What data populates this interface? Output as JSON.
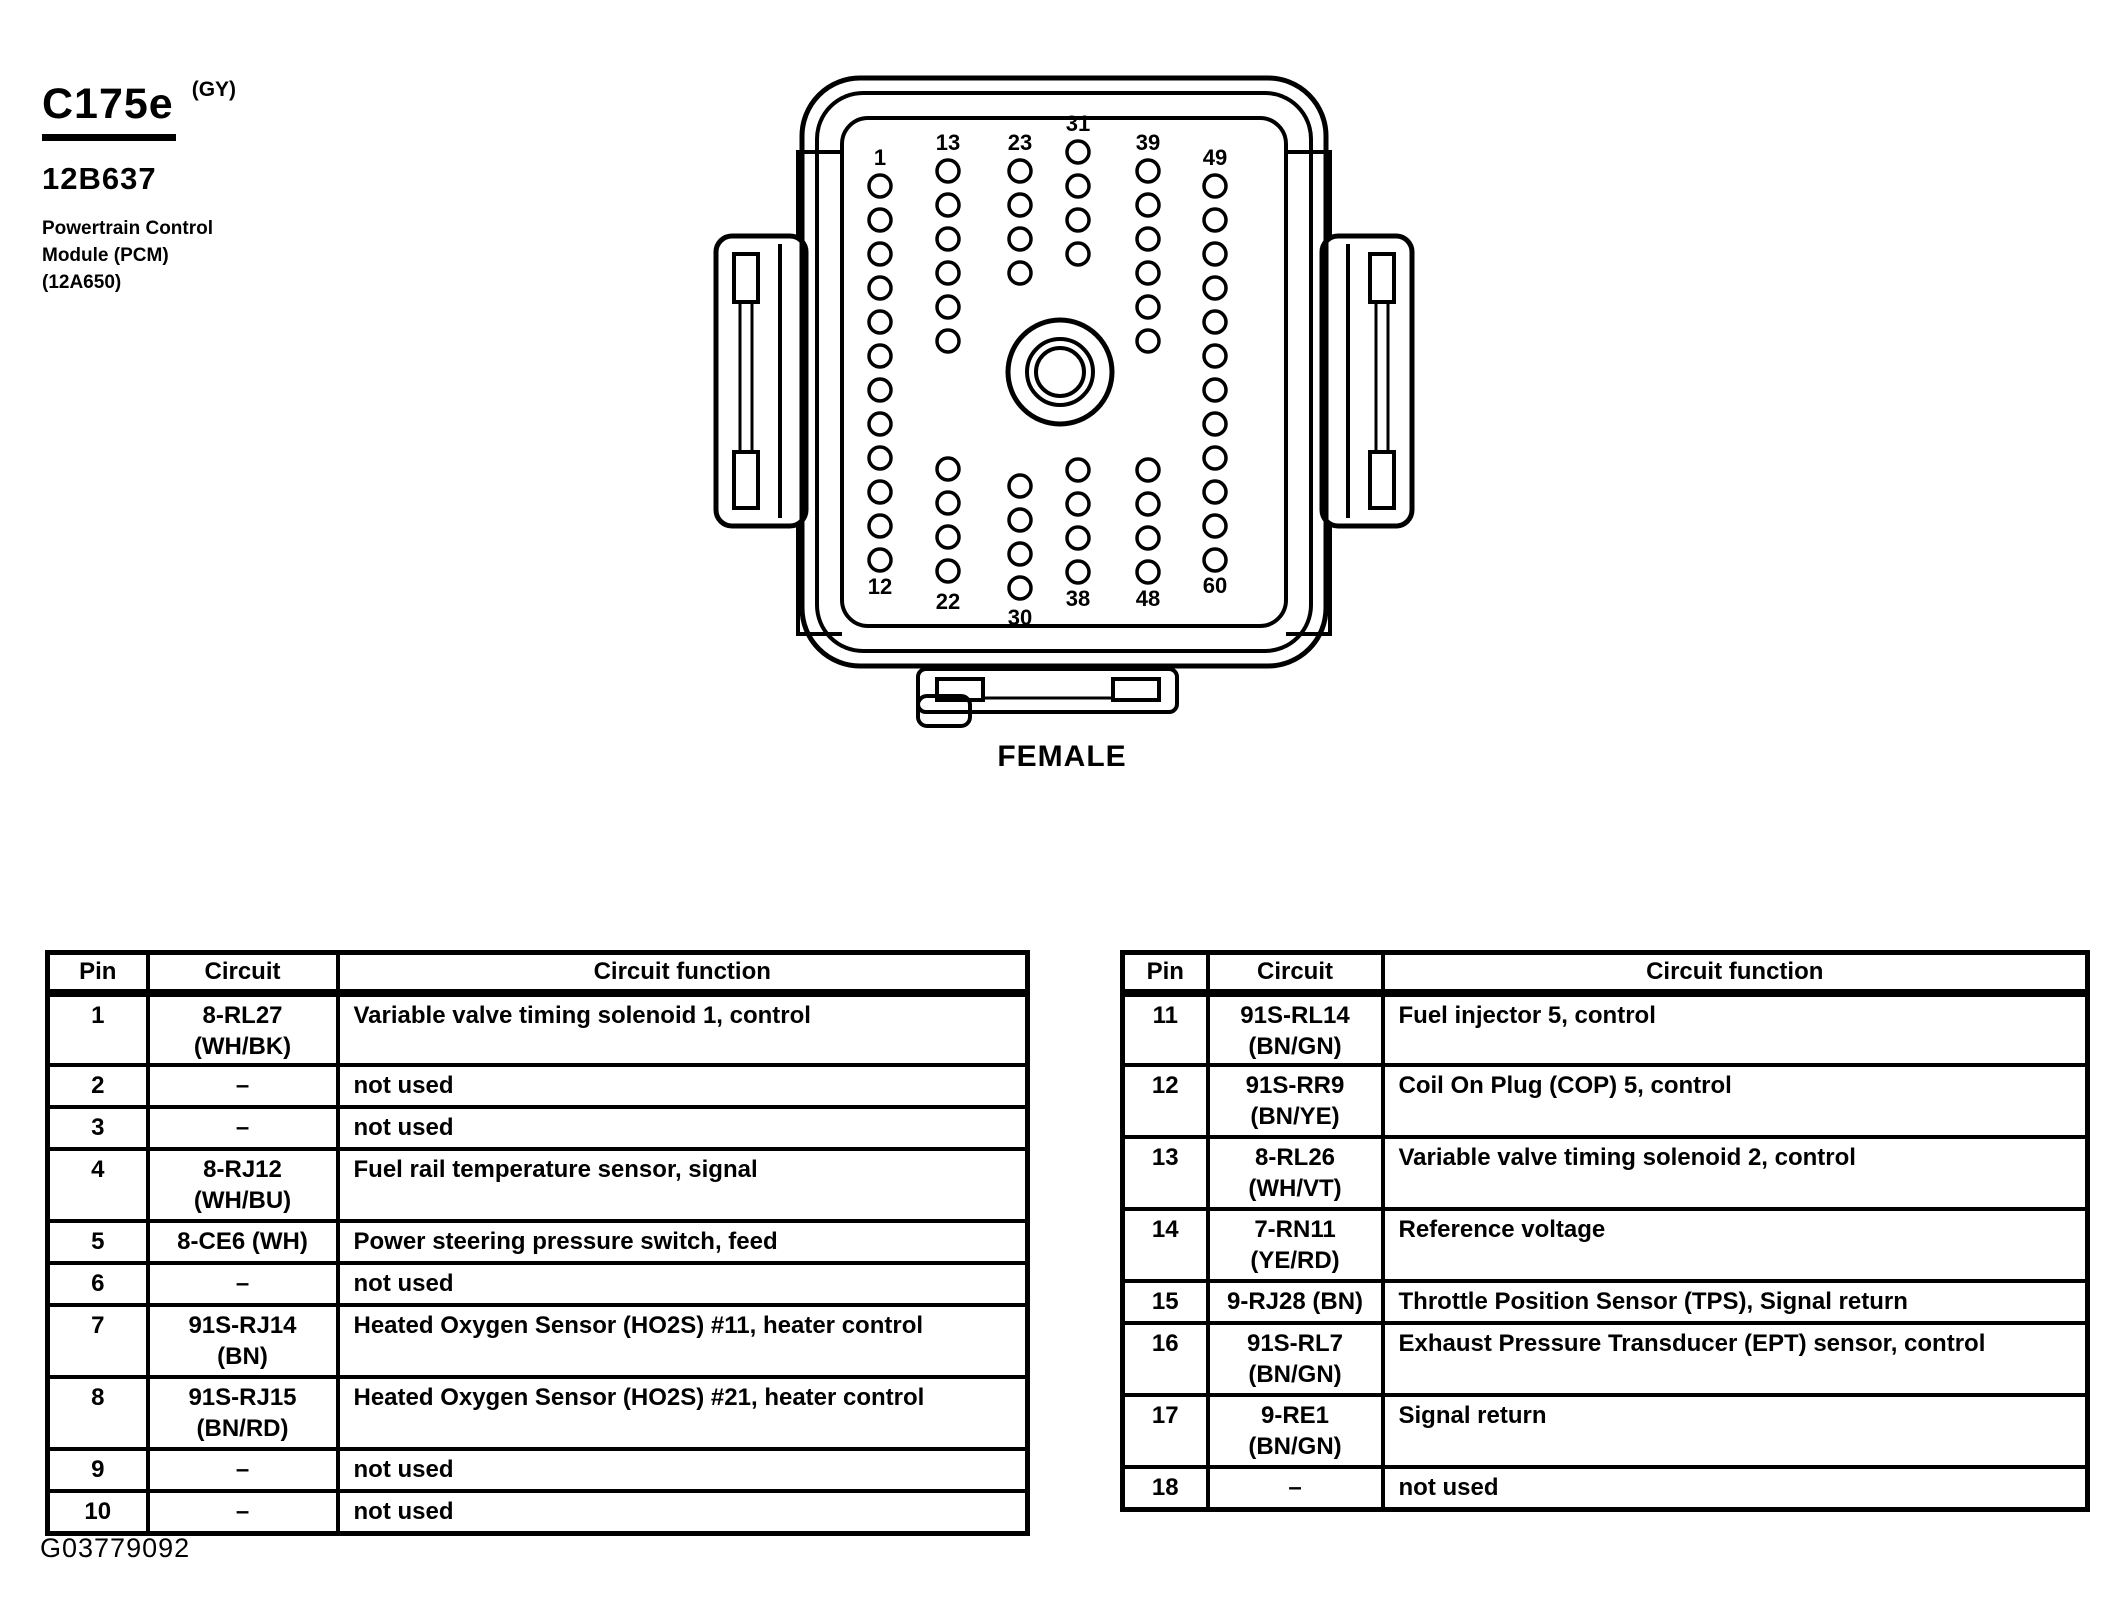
{
  "header": {
    "connector_id": "C175e",
    "connector_color_code": "(GY)",
    "part_number": "12B637",
    "component_lines": [
      "Powertrain Control",
      "Module (PCM)",
      "(12A650)"
    ]
  },
  "connector": {
    "caption": "FEMALE",
    "columns": [
      {
        "top": "1",
        "bottom": "12"
      },
      {
        "top": "13",
        "bottom": "22"
      },
      {
        "top": "23",
        "bottom": "30"
      },
      {
        "top": "31",
        "bottom": "38"
      },
      {
        "top": "39",
        "bottom": "48"
      },
      {
        "top": "49",
        "bottom": "60"
      }
    ]
  },
  "tables": {
    "headers": [
      "Pin",
      "Circuit",
      "Circuit function"
    ],
    "left": {
      "rows": [
        {
          "pin": "1",
          "circuit": [
            "8-RL27",
            "(WH/BK)"
          ],
          "function": "Variable valve timing solenoid 1, control"
        },
        {
          "pin": "2",
          "circuit": [
            "–"
          ],
          "function": "not used"
        },
        {
          "pin": "3",
          "circuit": [
            "–"
          ],
          "function": "not used"
        },
        {
          "pin": "4",
          "circuit": [
            "8-RJ12",
            "(WH/BU)"
          ],
          "function": "Fuel rail temperature sensor, signal"
        },
        {
          "pin": "5",
          "circuit": [
            "8-CE6 (WH)"
          ],
          "function": "Power steering pressure switch, feed"
        },
        {
          "pin": "6",
          "circuit": [
            "–"
          ],
          "function": "not used"
        },
        {
          "pin": "7",
          "circuit": [
            "91S-RJ14",
            "(BN)"
          ],
          "function": "Heated Oxygen Sensor (HO2S) #11, heater control"
        },
        {
          "pin": "8",
          "circuit": [
            "91S-RJ15",
            "(BN/RD)"
          ],
          "function": "Heated Oxygen Sensor (HO2S) #21, heater control"
        },
        {
          "pin": "9",
          "circuit": [
            "–"
          ],
          "function": "not used"
        },
        {
          "pin": "10",
          "circuit": [
            "–"
          ],
          "function": "not used"
        }
      ]
    },
    "right": {
      "rows": [
        {
          "pin": "11",
          "circuit": [
            "91S-RL14",
            "(BN/GN)"
          ],
          "function": "Fuel injector 5, control"
        },
        {
          "pin": "12",
          "circuit": [
            "91S-RR9",
            "(BN/YE)"
          ],
          "function": "Coil On Plug (COP) 5, control"
        },
        {
          "pin": "13",
          "circuit": [
            "8-RL26",
            "(WH/VT)"
          ],
          "function": "Variable valve timing solenoid 2, control"
        },
        {
          "pin": "14",
          "circuit": [
            "7-RN11",
            "(YE/RD)"
          ],
          "function": "Reference voltage"
        },
        {
          "pin": "15",
          "circuit": [
            "9-RJ28 (BN)"
          ],
          "function": "Throttle Position Sensor (TPS), Signal return"
        },
        {
          "pin": "16",
          "circuit": [
            "91S-RL7",
            "(BN/GN)"
          ],
          "function": "Exhaust Pressure Transducer (EPT) sensor, control"
        },
        {
          "pin": "17",
          "circuit": [
            "9-RE1",
            "(BN/GN)"
          ],
          "function": "Signal return"
        },
        {
          "pin": "18",
          "circuit": [
            "–"
          ],
          "function": "not used"
        }
      ]
    }
  },
  "footer": {
    "figure_id": "G03779092"
  },
  "colors": {
    "ink": "#000000",
    "paper": "#ffffff"
  }
}
